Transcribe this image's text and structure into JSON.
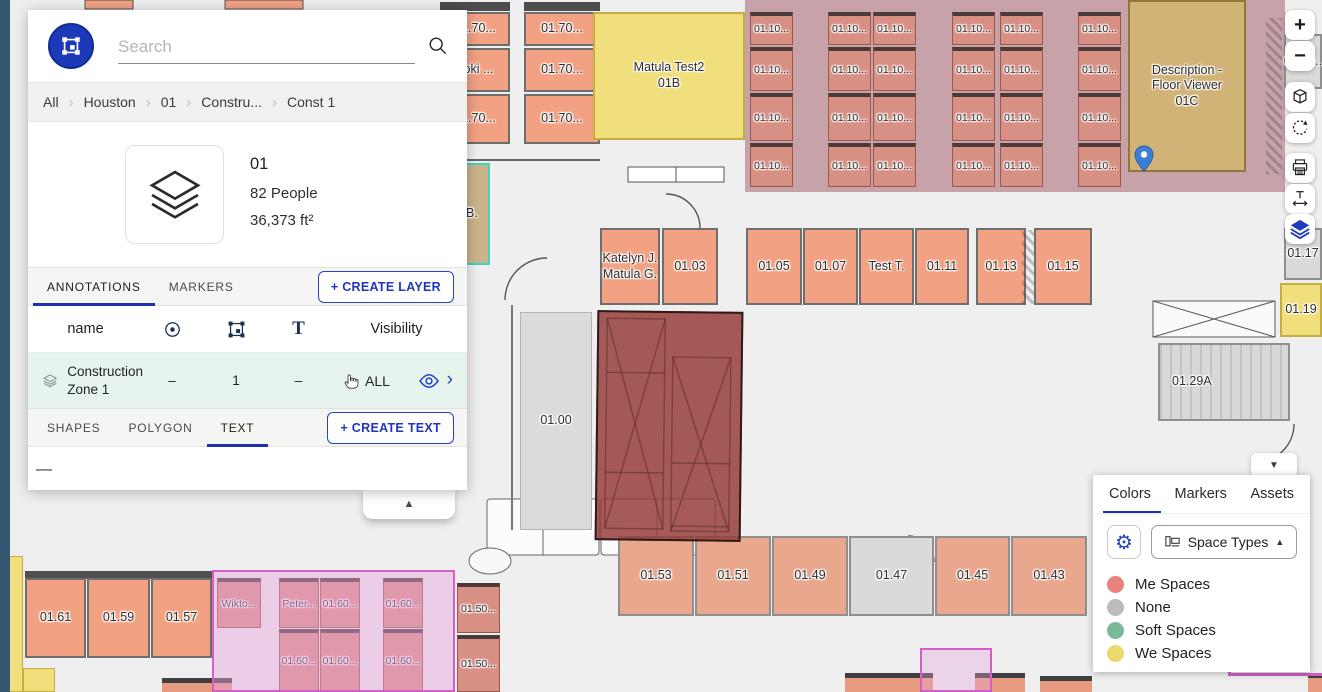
{
  "panel": {
    "search": {
      "placeholder": "Search"
    },
    "breadcrumb": [
      "All",
      "Houston",
      "01",
      "Constru...",
      "Const 1"
    ],
    "info": {
      "title": "01",
      "people": "82 People",
      "area": "36,373 ft²"
    },
    "layer_tabs": {
      "annotations": "ANNOTATIONS",
      "markers": "MARKERS",
      "create_layer": "+ CREATE LAYER"
    },
    "table": {
      "name": "name",
      "visibility": "Visibility"
    },
    "layer_row": {
      "name": "Construction Zone 1",
      "marker_count": "–",
      "shape_count": "1",
      "text_count": "–",
      "visibility": "ALL"
    },
    "shape_tabs": {
      "shapes": "SHAPES",
      "polygon": "POLYGON",
      "text": "TEXT",
      "create_text": "+ CREATE TEXT"
    },
    "empty_text": "—"
  },
  "toolbar": {
    "zoom_in": "+",
    "zoom_out": "−"
  },
  "icons": {
    "collapse_up": "▲",
    "collapse_down": "▼",
    "gear": "⚙",
    "breadcrumb_sep": "›",
    "row_chevron": "›"
  },
  "colors_panel": {
    "tabs": [
      "Colors",
      "Markers",
      "Assets"
    ],
    "active_tab": "Colors",
    "dropdown_label": "Space Types",
    "legend": [
      {
        "label": "Me Spaces",
        "color": "#E8827C"
      },
      {
        "label": "None",
        "color": "#BCBCBC"
      },
      {
        "label": "Soft Spaces",
        "color": "#7BBA96"
      },
      {
        "label": "We Spaces",
        "color": "#EAD96B"
      }
    ]
  },
  "floorplan": {
    "rooms": [
      {
        "label": "01.70...",
        "x": 440,
        "y": 12,
        "w": 70,
        "h": 34,
        "cls": "salmon"
      },
      {
        "label": "Loki ...",
        "x": 440,
        "y": 48,
        "w": 70,
        "h": 44,
        "cls": "salmon"
      },
      {
        "label": "01.70...",
        "x": 440,
        "y": 94,
        "w": 70,
        "h": 50,
        "cls": "salmon"
      },
      {
        "label": "01.70...",
        "x": 524,
        "y": 12,
        "w": 76,
        "h": 34,
        "cls": "salmon"
      },
      {
        "label": "01.70...",
        "x": 524,
        "y": 48,
        "w": 76,
        "h": 44,
        "cls": "salmon"
      },
      {
        "label": "01.70...",
        "x": 524,
        "y": 94,
        "w": 76,
        "h": 50,
        "cls": "salmon"
      },
      {
        "label": "Matula Test2\n01B",
        "x": 593,
        "y": 12,
        "w": 152,
        "h": 128,
        "cls": "yellow"
      },
      {
        "label": "Description -\nFloor Viewer\n01C",
        "x": 1128,
        "y": 0,
        "w": 118,
        "h": 172,
        "cls": "tan"
      },
      {
        "label": "01.20..",
        "x": 1284,
        "y": 34,
        "w": 38,
        "h": 55,
        "cls": "gray"
      },
      {
        "label": "Katelyn J.\nMatula G.",
        "x": 600,
        "y": 228,
        "w": 60,
        "h": 77,
        "cls": "salmon"
      },
      {
        "label": "01.03",
        "x": 662,
        "y": 228,
        "w": 56,
        "h": 77,
        "cls": "salmon"
      },
      {
        "label": "01.05",
        "x": 746,
        "y": 228,
        "w": 56,
        "h": 77,
        "cls": "salmon"
      },
      {
        "label": "01.07",
        "x": 803,
        "y": 228,
        "w": 55,
        "h": 77,
        "cls": "salmon"
      },
      {
        "label": "Test T.",
        "x": 859,
        "y": 228,
        "w": 55,
        "h": 77,
        "cls": "salmon"
      },
      {
        "label": "01.11",
        "x": 915,
        "y": 228,
        "w": 54,
        "h": 77,
        "cls": "salmon"
      },
      {
        "label": "01.13",
        "x": 976,
        "y": 228,
        "w": 50,
        "h": 77,
        "cls": "salmon"
      },
      {
        "label": "01.15",
        "x": 1034,
        "y": 228,
        "w": 58,
        "h": 77,
        "cls": "salmon"
      },
      {
        "label": "01.17",
        "x": 1284,
        "y": 228,
        "w": 38,
        "h": 52,
        "cls": "gray"
      },
      {
        "label": "01.19",
        "x": 1280,
        "y": 283,
        "w": 42,
        "h": 54,
        "cls": "yellow"
      },
      {
        "label": "B.",
        "x": 452,
        "y": 163,
        "w": 38,
        "h": 102,
        "cls": "teal",
        "lpos": "l"
      },
      {
        "label": "01.00",
        "x": 520,
        "y": 312,
        "w": 72,
        "h": 218,
        "cls": "gray2"
      },
      {
        "label": "01.29A",
        "x": 1158,
        "y": 343,
        "w": 132,
        "h": 78,
        "cls": "gray-stairs",
        "lpos": "l"
      },
      {
        "label": "01.53",
        "x": 618,
        "y": 536,
        "w": 76,
        "h": 80,
        "cls": "salmon-light"
      },
      {
        "label": "01.51",
        "x": 695,
        "y": 536,
        "w": 76,
        "h": 80,
        "cls": "salmon-light"
      },
      {
        "label": "01.49",
        "x": 772,
        "y": 536,
        "w": 76,
        "h": 80,
        "cls": "salmon-light"
      },
      {
        "label": "01.47",
        "x": 849,
        "y": 536,
        "w": 85,
        "h": 80,
        "cls": "gray"
      },
      {
        "label": "01.45",
        "x": 935,
        "y": 536,
        "w": 75,
        "h": 80,
        "cls": "salmon-light"
      },
      {
        "label": "01.43",
        "x": 1011,
        "y": 536,
        "w": 76,
        "h": 80,
        "cls": "salmon-light"
      },
      {
        "label": "01.61",
        "x": 25,
        "y": 578,
        "w": 61,
        "h": 80,
        "cls": "salmon"
      },
      {
        "label": "01.59",
        "x": 87,
        "y": 578,
        "w": 63,
        "h": 80,
        "cls": "salmon"
      },
      {
        "label": "01.57",
        "x": 151,
        "y": 578,
        "w": 61,
        "h": 80,
        "cls": "salmon"
      },
      {
        "label": "Wikto...",
        "x": 217,
        "y": 578,
        "w": 44,
        "h": 50,
        "cls": "desk"
      },
      {
        "label": "Peter...",
        "x": 279,
        "y": 578,
        "w": 40,
        "h": 50,
        "cls": "desk"
      },
      {
        "label": "01.60...",
        "x": 320,
        "y": 578,
        "w": 40,
        "h": 50,
        "cls": "desk"
      },
      {
        "label": "01.60...",
        "x": 383,
        "y": 578,
        "w": 40,
        "h": 50,
        "cls": "desk"
      },
      {
        "label": "01.60...",
        "x": 279,
        "y": 629,
        "w": 40,
        "h": 63,
        "cls": "desk"
      },
      {
        "label": "01.60...",
        "x": 320,
        "y": 629,
        "w": 40,
        "h": 63,
        "cls": "desk"
      },
      {
        "label": "01.60...",
        "x": 383,
        "y": 629,
        "w": 40,
        "h": 63,
        "cls": "desk"
      },
      {
        "label": "01.50...",
        "x": 457,
        "y": 583,
        "w": 43,
        "h": 50,
        "cls": "desk"
      },
      {
        "label": "01.50...",
        "x": 457,
        "y": 635,
        "w": 43,
        "h": 57,
        "cls": "desk"
      }
    ],
    "desk_grid": {
      "label": "01.10...",
      "cols": [
        750,
        828,
        873,
        952,
        1000,
        1078
      ],
      "rows": [
        12,
        47,
        93,
        143
      ],
      "w": 43,
      "h": [
        33,
        44,
        48,
        44
      ]
    },
    "zone_name": "Construction Zone 1"
  }
}
